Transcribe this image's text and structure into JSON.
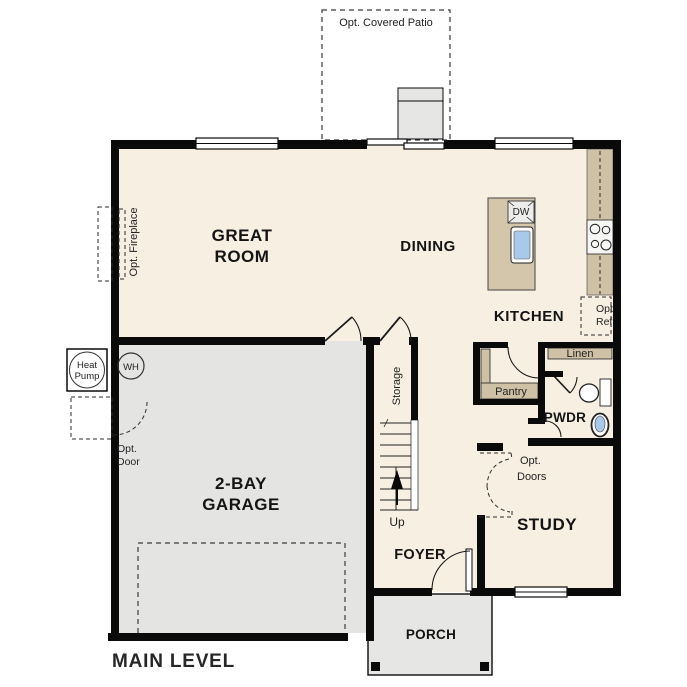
{
  "title": "MAIN LEVEL",
  "labels": {
    "patio": "Opt. Covered Patio",
    "great_room_1": "GREAT",
    "great_room_2": "ROOM",
    "dining": "DINING",
    "kitchen": "KITCHEN",
    "dw": "DW",
    "opt_ref_1": "Opt.",
    "opt_ref_2": "Ref",
    "fireplace": "Opt. Fireplace",
    "heat_pump_1": "Heat",
    "heat_pump_2": "Pump",
    "wh": "WH",
    "opt_door_1": "Opt.",
    "opt_door_2": "Door",
    "garage_1": "2-BAY",
    "garage_2": "GARAGE",
    "storage": "Storage",
    "up": "Up",
    "pantry": "Pantry",
    "linen": "Linen",
    "pwdr": "PWDR",
    "opt_doors_1": "Opt.",
    "opt_doors_2": "Doors",
    "study": "STUDY",
    "foyer": "FOYER",
    "porch": "PORCH",
    "main_level": "MAIN LEVEL"
  },
  "colors": {
    "wall": "#0a0a0a",
    "floor": "#f7efe2",
    "garage": "#e4e4e2",
    "patio": "#e6e6e4",
    "porch": "#e6e6e4",
    "counter": "#cfc1a5",
    "island": "#d3c6ab",
    "shelf": "#cfc1a5",
    "fixture_blue": "#a9c9ea",
    "appliance": "#ececea",
    "window": "#ffffff",
    "text": "#141414",
    "muted_text": "#333333"
  }
}
